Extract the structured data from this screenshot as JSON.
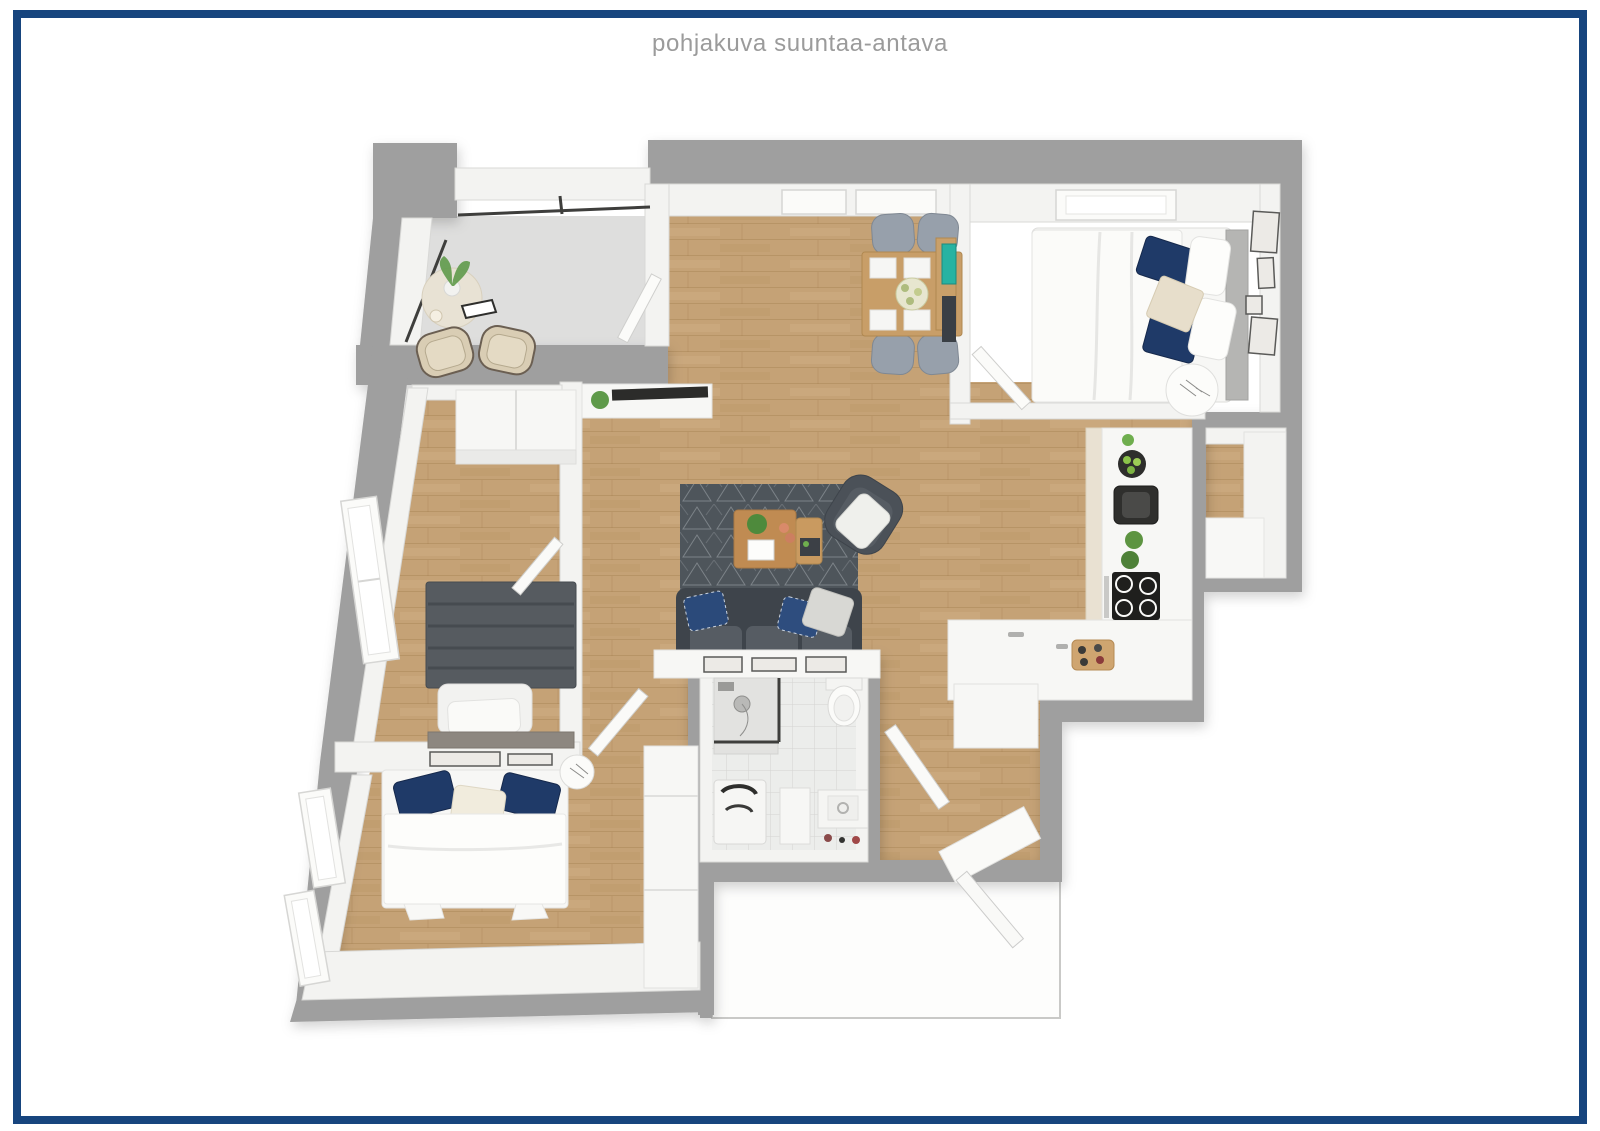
{
  "header": {
    "title": "pohjakuva suuntaa-antava"
  },
  "frame": {
    "border_color": "#17457e",
    "border_width_px": 8,
    "background": "#ffffff"
  },
  "palette": {
    "title_color": "#9b9b9b",
    "wall_outer": "#9f9f9f",
    "wall_inner": "#f3f3f1",
    "wood": "#c5a276",
    "wood_line": "#a5814f",
    "concrete": "#dededd",
    "tile": "#ecedeb",
    "tile_line": "#d4d4d2",
    "rug": "#4e555b",
    "rug_line": "#9ba1a7",
    "sofa": "#4b5158",
    "navy": "#1f3a68",
    "table_wood": "#c89e68",
    "chair_gray": "#97a0ab",
    "plant": "#5f9a4a",
    "teal": "#27b3a2",
    "appliance": "#232321",
    "bed_white": "#f7f7f5",
    "dark_bed": "#565b60"
  },
  "plan": {
    "type": "3d-top-down-floor-plan",
    "rooms": [
      {
        "name": "balcony",
        "floor": "concrete",
        "furniture": [
          "bistro-table",
          "green-plant",
          "two-rattan-chairs",
          "round-rug",
          "glass-railing",
          "balcony-door"
        ]
      },
      {
        "name": "dining-area",
        "floor": "wood",
        "furniture": [
          "wooden-dining-table",
          "four-gray-chairs",
          "white-place-settings",
          "flower-centerpiece",
          "two-windows"
        ]
      },
      {
        "name": "bedroom-top-right",
        "floor": "wood",
        "furniture": [
          "double-bed-white",
          "navy-pillows",
          "gray-headboard",
          "round-side-table",
          "wall-art-frames",
          "window",
          "door"
        ]
      },
      {
        "name": "kitchen",
        "floor": "wood",
        "furniture": [
          "l-shaped-white-counter",
          "black-sink-unit",
          "black-cooktop",
          "oven",
          "fruit-bowl",
          "herb-pots",
          "cutting-board"
        ]
      },
      {
        "name": "storage-closet",
        "floor": "wood",
        "furniture": [
          "white-cabinet"
        ]
      },
      {
        "name": "living-room",
        "floor": "wood",
        "furniture": [
          "dark-gray-sofa",
          "patterned-rug",
          "wood-coffee-table",
          "armchair-with-blanket",
          "tv-sideboard",
          "console-with-frames"
        ]
      },
      {
        "name": "bathroom",
        "floor": "tile",
        "furniture": [
          "shower",
          "toilet",
          "washing-machine",
          "storage-unit",
          "vanity-sink",
          "door"
        ]
      },
      {
        "name": "bedroom-left",
        "floor": "wood",
        "furniture": [
          "dark-gray-bed",
          "white-pillows",
          "wardrobe",
          "bench",
          "window",
          "door"
        ]
      },
      {
        "name": "bedroom-bottom-left",
        "floor": "wood",
        "furniture": [
          "double-bed-white",
          "navy-pillows",
          "tall-wardrobe",
          "round-side-table",
          "two-windows",
          "door"
        ]
      },
      {
        "name": "entry-hall",
        "floor": "wood",
        "furniture": [
          "white-closet",
          "threshold-mat",
          "entry-door",
          "landing"
        ]
      }
    ]
  }
}
